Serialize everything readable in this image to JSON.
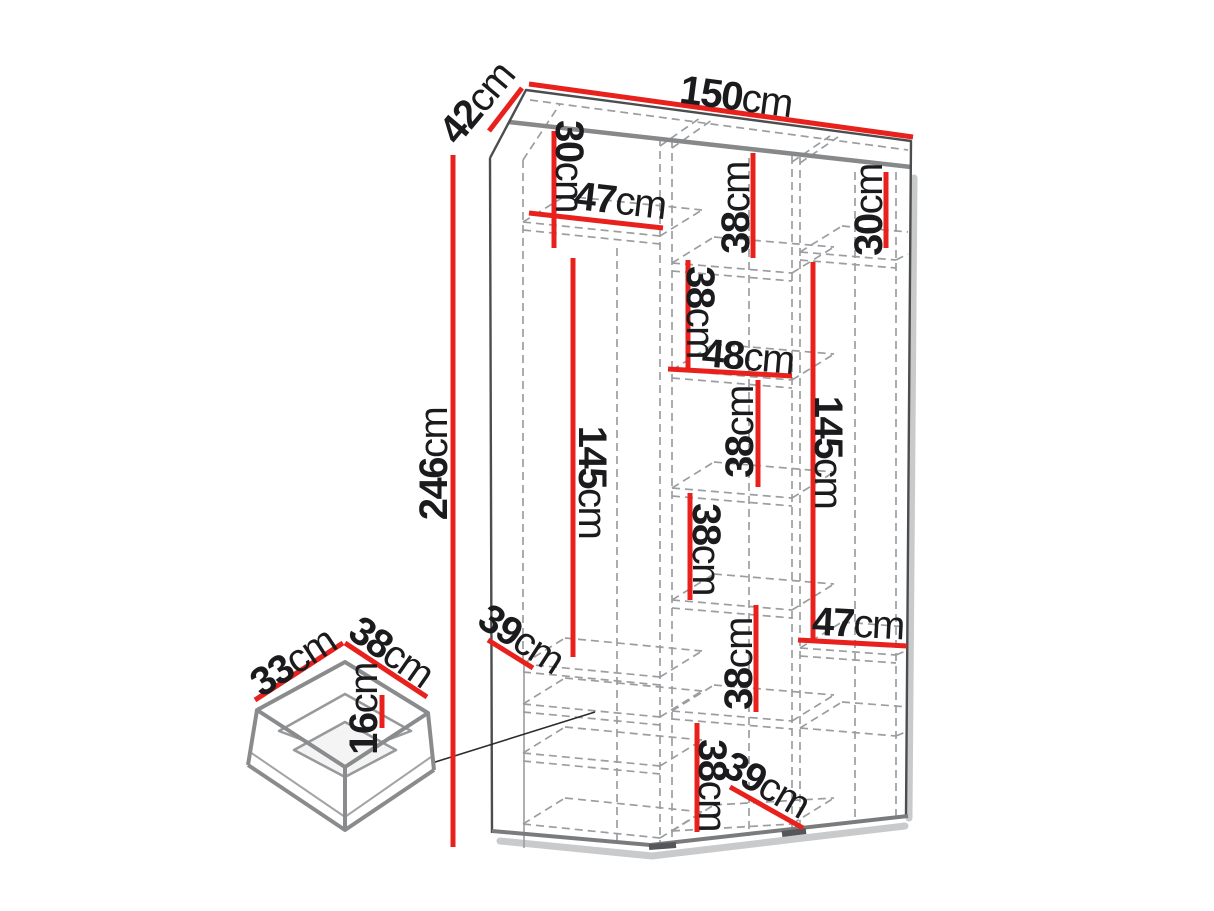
{
  "unit": "cm",
  "colors": {
    "dimension_line": "#e8211d",
    "outline": "#4c4d4f",
    "panel_edge": "#87888a",
    "dashed_line": "#9b9da0",
    "label_text": "#1b1b1d",
    "shadow": "#c9cacc"
  },
  "wardrobe": {
    "overall": {
      "width": {
        "value": "150",
        "unit": "cm"
      },
      "depth": {
        "value": "42",
        "unit": "cm"
      },
      "height": {
        "value": "246",
        "unit": "cm"
      }
    },
    "left_column": {
      "top_shelf_height": {
        "value": "30",
        "unit": "cm"
      },
      "inner_width": {
        "value": "47",
        "unit": "cm"
      },
      "hanging_height": {
        "value": "145",
        "unit": "cm"
      },
      "shelf_depth": {
        "value": "39",
        "unit": "cm"
      }
    },
    "middle_column": {
      "inner_width": {
        "value": "48",
        "unit": "cm"
      },
      "bottom_depth": {
        "value": "39",
        "unit": "cm"
      },
      "compartments": [
        {
          "value": "38",
          "unit": "cm"
        },
        {
          "value": "38",
          "unit": "cm"
        },
        {
          "value": "38",
          "unit": "cm"
        },
        {
          "value": "38",
          "unit": "cm"
        },
        {
          "value": "38",
          "unit": "cm"
        },
        {
          "value": "38",
          "unit": "cm"
        }
      ]
    },
    "right_column": {
      "top_shelf_height": {
        "value": "30",
        "unit": "cm"
      },
      "hanging_height": {
        "value": "145",
        "unit": "cm"
      },
      "inner_width": {
        "value": "47",
        "unit": "cm"
      }
    }
  },
  "drawer": {
    "width": {
      "value": "33",
      "unit": "cm"
    },
    "depth": {
      "value": "38",
      "unit": "cm"
    },
    "height": {
      "value": "16",
      "unit": "cm"
    }
  }
}
